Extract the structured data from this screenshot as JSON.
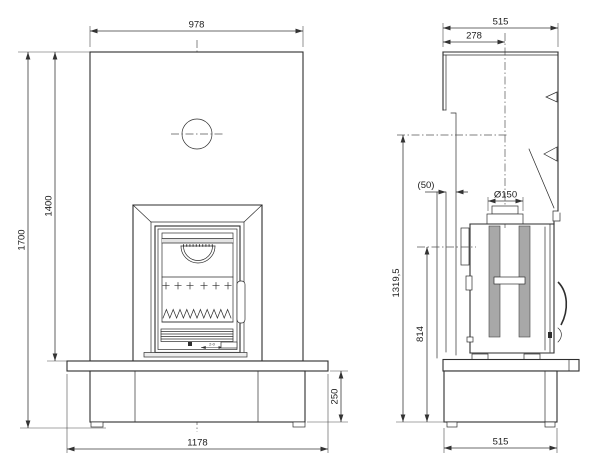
{
  "colors": {
    "background": "#ffffff",
    "line": "#2e2e2e",
    "dim": "#3a3a3a",
    "slot_fill": "#a8a8a8",
    "band_fill": "#e3e3e3"
  },
  "dims": {
    "front": {
      "panel_width": "978",
      "panel_height": "1400",
      "total_height": "1700",
      "plinth_height": "250",
      "bench_width": "1178",
      "air_slider": "2-0"
    },
    "side": {
      "depth_top": "515",
      "flue_offset": "278",
      "wall_gap": "(50)",
      "flue_diameter": "Ø150",
      "upper_outlet_height": "1319,5",
      "rear_outlet_height": "814",
      "depth_bottom": "515"
    }
  }
}
